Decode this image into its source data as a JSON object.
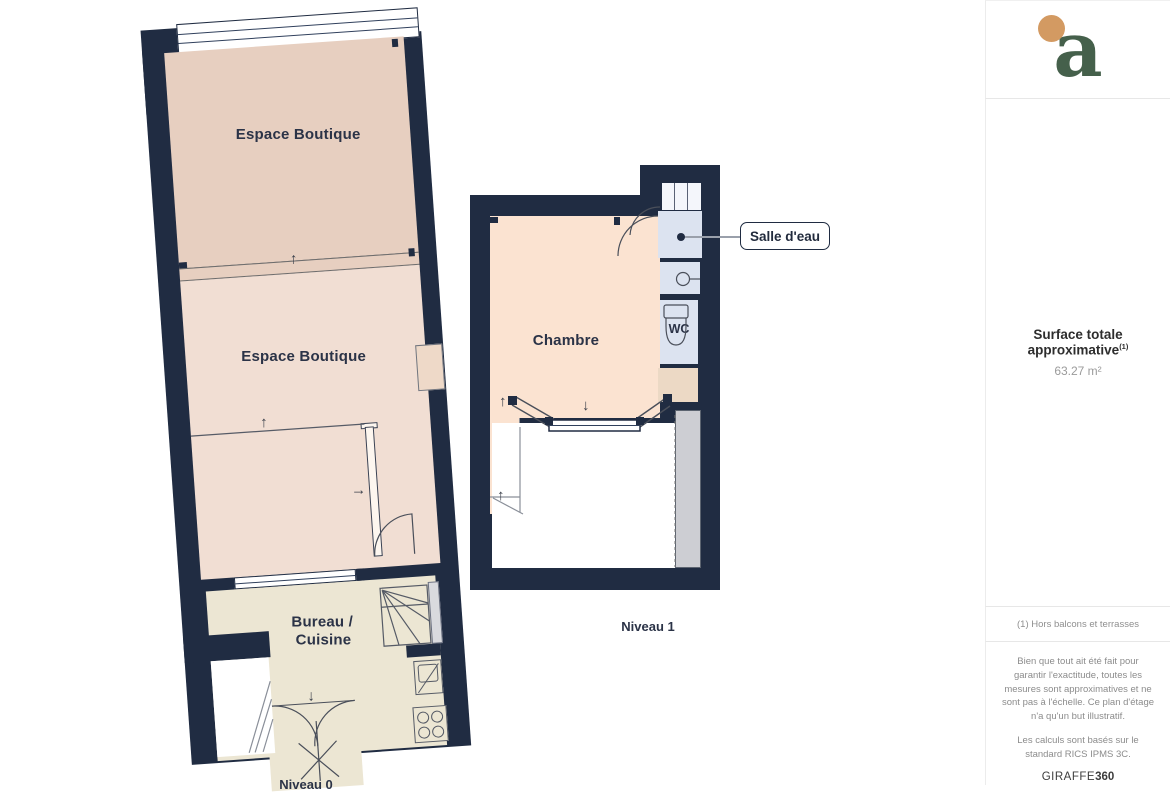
{
  "colors": {
    "wall": "#202c42",
    "boutique_top": "#e7cfc0",
    "boutique_mid": "#f1ded3",
    "chambre": "#fbe3d1",
    "bath": "#dce3f0",
    "entry": "#ecd9c5",
    "office": "#ece6d3",
    "terrace_gray": "#cdced3",
    "logo_green": "#45604b",
    "logo_orange": "#d39a62"
  },
  "icons": {
    "arrow_up": "↑",
    "arrow_down": "↓",
    "arrow_right": "→"
  },
  "floorplan": {
    "level0": {
      "label": "Niveau 0",
      "room_boutique_top": "Espace Boutique",
      "room_boutique_mid": "Espace Boutique",
      "room_office_line1": "Bureau /",
      "room_office_line2": "Cuisine"
    },
    "level1": {
      "label": "Niveau 1",
      "room_chambre": "Chambre",
      "room_wc": "WC",
      "callout_salle_deau": "Salle d'eau"
    }
  },
  "sidebar": {
    "logo_letter": "a",
    "surface_title": "Surface totale approximative",
    "surface_sup": "(1)",
    "surface_value": "63.27 m²",
    "footnote": "(1) Hors balcons et terrasses",
    "disclaimer_1": "Bien que tout ait été fait pour garantir l'exactitude, toutes les mesures sont approximatives et ne sont pas à l'échelle. Ce plan d'étage n'a qu'un but illustratif.",
    "disclaimer_2": "Les calculs sont basés sur le standard RICS IPMS 3C.",
    "brand_name": "GIRAFFE",
    "brand_suffix": "360"
  }
}
